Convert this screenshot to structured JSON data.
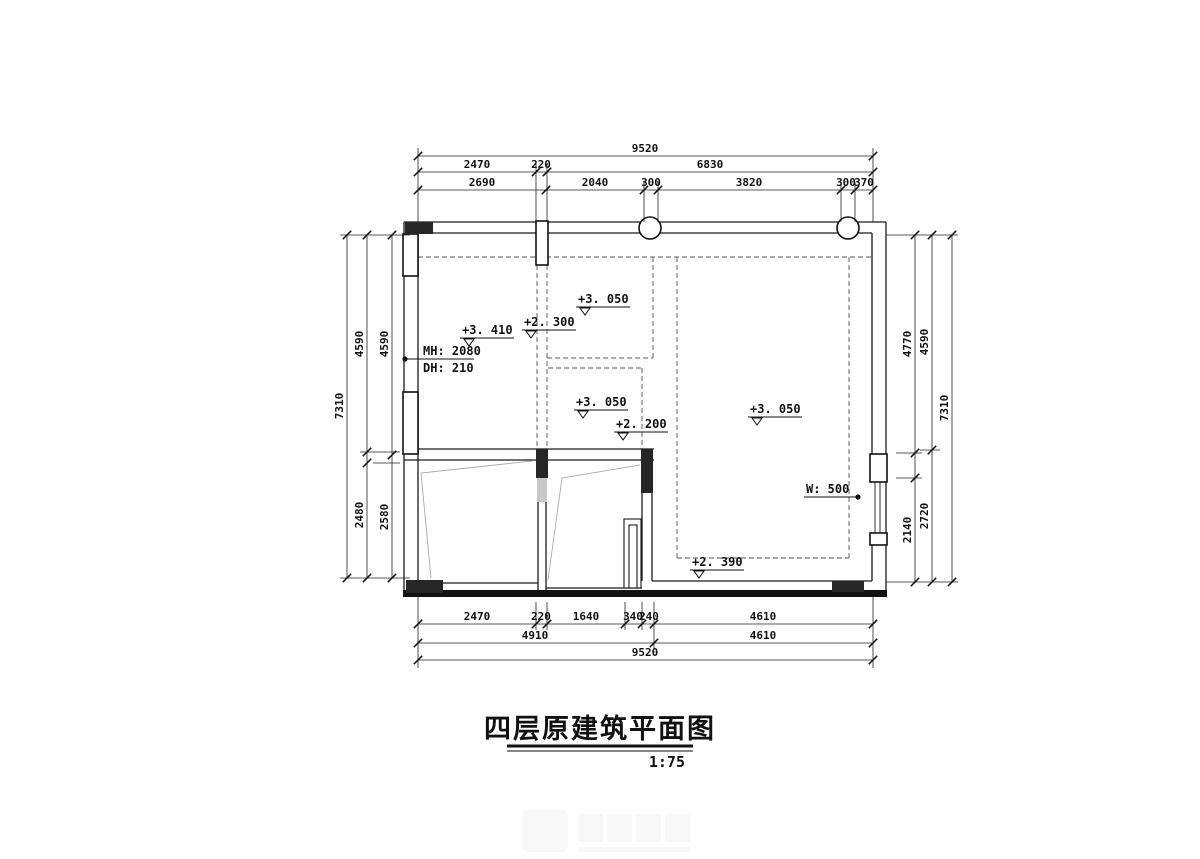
{
  "title": {
    "text": "四层原建筑平面图",
    "scale": "1:75"
  },
  "plan": {
    "levels": {
      "upper_mid": "+3. 050",
      "entry": "+2. 300",
      "left_room": "+3. 410",
      "mid_room": "+3. 050",
      "mid_low": "+2. 200",
      "right_room": "+3. 050",
      "bottom_right": "+2. 390"
    },
    "notes": {
      "mh": "MH: 2080",
      "dh": "DH:  210",
      "win": "W:  500"
    }
  },
  "dims": {
    "top": {
      "overall": "9520",
      "row2": [
        "2470",
        "220",
        "6830"
      ],
      "row3": [
        "2690",
        "2040",
        "300",
        "3820",
        "300",
        "370"
      ]
    },
    "bottom": {
      "row1": [
        "2470",
        "220",
        "1640",
        "340",
        "240",
        "4610"
      ],
      "row2": [
        "4910",
        "4610"
      ],
      "overall": "9520"
    },
    "left": {
      "outer": "7310",
      "middle": [
        "4590",
        "2480"
      ],
      "inner": [
        "4590",
        "2580"
      ]
    },
    "right": {
      "inner": [
        "4770",
        "2140"
      ],
      "middle": [
        "4590",
        "2720"
      ],
      "outer": "7310"
    }
  }
}
